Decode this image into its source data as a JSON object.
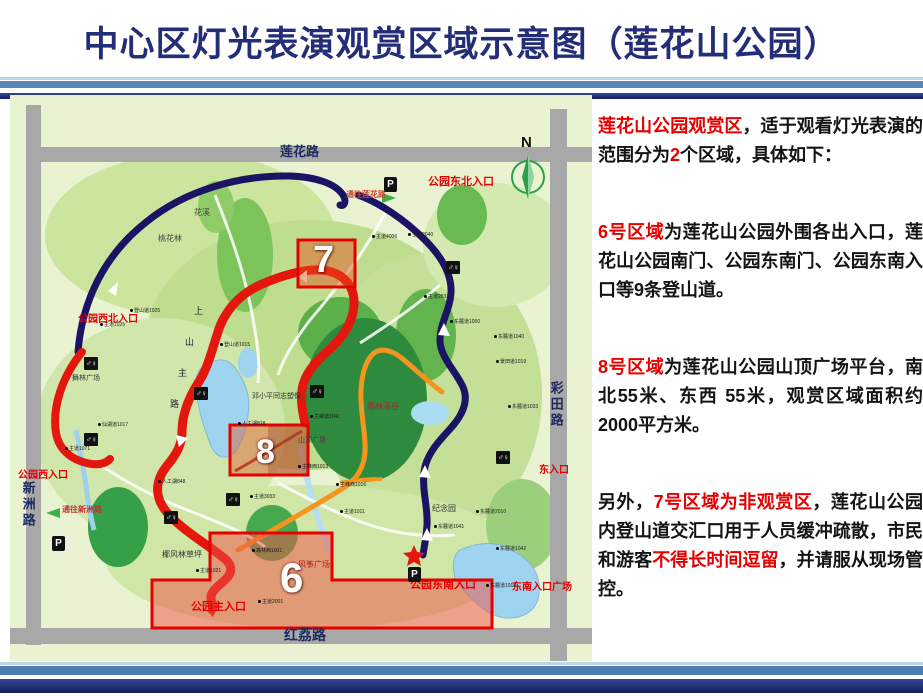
{
  "title": "中心区灯光表演观赏区域示意图（莲花山公园）",
  "colors": {
    "title": "#242e78",
    "red_accent": "#e60000",
    "map_bg": "#e9f2d1",
    "route_blue": "#1b1464",
    "route_red": "#e3170d",
    "route_orange": "#f5941f",
    "road_gray": "#a8a8a8",
    "region_fill": "rgba(240,85,60,0.5)"
  },
  "panel": {
    "paragraphs": [
      {
        "gap": "none",
        "segments": [
          {
            "t": "莲花山公园观赏区",
            "red": true
          },
          {
            "t": "，适于观看灯光表演的范围分为",
            "red": false
          },
          {
            "t": "2",
            "red": true
          },
          {
            "t": "个区域，具体如下：",
            "red": false
          }
        ]
      },
      {
        "gap": "gap2",
        "segments": [
          {
            "t": "6号区域",
            "red": true
          },
          {
            "t": "为莲花山公园外围各出入口，莲花山公园南门、公园东南门、公园东南入口等9条登山道。",
            "red": false
          }
        ]
      },
      {
        "gap": "gap2",
        "segments": [
          {
            "t": "8号区域",
            "red": true
          },
          {
            "t": "为莲花山公园山顶广场平台，南北55米、东西 55米，观赏区域面积约2000平方米。",
            "red": false
          }
        ]
      },
      {
        "gap": "gap2",
        "segments": [
          {
            "t": "另外，",
            "red": false
          },
          {
            "t": "7号区域为非观赏区",
            "red": true
          },
          {
            "t": "，莲花山公园内登山道交汇口用于人员缓冲疏散，市民和游客",
            "red": false
          },
          {
            "t": "不得长时间逗留",
            "red": true
          },
          {
            "t": "，并请服从现场管控。",
            "red": false
          }
        ]
      }
    ]
  },
  "map": {
    "roads": {
      "top": "莲花路",
      "right": "彩田路",
      "bottom": "红荔路",
      "left": "新洲路"
    },
    "compass": "N",
    "regions": [
      {
        "id": "region-7",
        "label": "7",
        "x": 303,
        "y": 146,
        "size": 38
      },
      {
        "id": "region-8",
        "label": "8",
        "x": 246,
        "y": 340,
        "size": 34
      },
      {
        "id": "region-6",
        "label": "6",
        "x": 270,
        "y": 462,
        "size": 42
      }
    ],
    "labels": [
      {
        "t": "莲花路",
        "x": 270,
        "y": 50,
        "s": 13,
        "c": "#1c2a60",
        "b": 1
      },
      {
        "t": "红荔路",
        "x": 274,
        "y": 533,
        "s": 14,
        "c": "#1c2a60",
        "b": 1
      },
      {
        "t": "彩田路",
        "x": 539,
        "y": 286,
        "s": 13,
        "c": "#1c2a60",
        "b": 1,
        "v": 1
      },
      {
        "t": "新洲路",
        "x": 11,
        "y": 386,
        "s": 13,
        "c": "#1c2a60",
        "b": 1,
        "v": 1
      },
      {
        "t": "N",
        "x": 511,
        "y": 40,
        "s": 15,
        "c": "#111111",
        "b": 1
      },
      {
        "t": "公园东北入口",
        "x": 418,
        "y": 82,
        "s": 11,
        "c": "#e60000",
        "b": 1
      },
      {
        "t": "通往莲花路",
        "x": 336,
        "y": 96,
        "s": 8,
        "c": "#cc4433",
        "b": 1
      },
      {
        "t": "公园西北入口",
        "x": 68,
        "y": 220,
        "s": 10,
        "c": "#e60000",
        "b": 1
      },
      {
        "t": "公园西入口",
        "x": 8,
        "y": 376,
        "s": 10,
        "c": "#e60000",
        "b": 1
      },
      {
        "t": "通往新洲路",
        "x": 52,
        "y": 411,
        "s": 8,
        "c": "#c23333",
        "b": 1
      },
      {
        "t": "公园主入口",
        "x": 181,
        "y": 507,
        "s": 11,
        "c": "#e60000",
        "b": 1
      },
      {
        "t": "公园东南入口",
        "x": 400,
        "y": 485,
        "s": 11,
        "c": "#e60000",
        "b": 1
      },
      {
        "t": "东南入口广场",
        "x": 502,
        "y": 488,
        "s": 10,
        "c": "#e60000",
        "b": 1
      },
      {
        "t": "东入口",
        "x": 529,
        "y": 371,
        "s": 10,
        "c": "#e60000",
        "b": 1
      },
      {
        "t": "花溪",
        "x": 184,
        "y": 114,
        "s": 8,
        "c": "#444444"
      },
      {
        "t": "桃花林",
        "x": 148,
        "y": 140,
        "s": 8,
        "c": "#444444"
      },
      {
        "t": "邓小平同志塑像",
        "x": 242,
        "y": 298,
        "s": 7,
        "c": "#333333"
      },
      {
        "t": "山顶广场",
        "x": 288,
        "y": 342,
        "s": 7,
        "c": "#553333"
      },
      {
        "t": "雨林溪谷",
        "x": 357,
        "y": 308,
        "s": 8,
        "c": "#aa2233"
      },
      {
        "t": "纪念园",
        "x": 422,
        "y": 410,
        "s": 8,
        "c": "#333333"
      },
      {
        "t": "椰风林草坪",
        "x": 152,
        "y": 456,
        "s": 8,
        "c": "#333333"
      },
      {
        "t": "风筝广场",
        "x": 288,
        "y": 466,
        "s": 8,
        "c": "#aa2222"
      },
      {
        "t": "舞林广场",
        "x": 62,
        "y": 280,
        "s": 7,
        "c": "#333333"
      },
      {
        "t": "上",
        "x": 184,
        "y": 212,
        "s": 9,
        "c": "#222233"
      },
      {
        "t": "山",
        "x": 175,
        "y": 243,
        "s": 9,
        "c": "#222233"
      },
      {
        "t": "主",
        "x": 168,
        "y": 274,
        "s": 9,
        "c": "#222233"
      },
      {
        "t": "路",
        "x": 160,
        "y": 305,
        "s": 9,
        "c": "#222233"
      }
    ],
    "markers": [
      {
        "t": "主道1025",
        "x": 90,
        "y": 228
      },
      {
        "t": "登山道1025",
        "x": 120,
        "y": 214
      },
      {
        "t": "主道4006",
        "x": 362,
        "y": 140
      },
      {
        "t": "主道2040",
        "x": 398,
        "y": 138
      },
      {
        "t": "主道2833",
        "x": 414,
        "y": 200
      },
      {
        "t": "东麓道1050",
        "x": 440,
        "y": 225
      },
      {
        "t": "东麓道1040",
        "x": 484,
        "y": 240
      },
      {
        "t": "景田道1019",
        "x": 486,
        "y": 265
      },
      {
        "t": "东麓道1033",
        "x": 498,
        "y": 310
      },
      {
        "t": "主峰西1013",
        "x": 288,
        "y": 370
      },
      {
        "t": "主峰西1016",
        "x": 326,
        "y": 388
      },
      {
        "t": "主道3033",
        "x": 240,
        "y": 400
      },
      {
        "t": "人工湖848",
        "x": 148,
        "y": 385
      },
      {
        "t": "人工湖818",
        "x": 228,
        "y": 327
      },
      {
        "t": "主道1021",
        "x": 186,
        "y": 474
      },
      {
        "t": "森林西1001",
        "x": 242,
        "y": 454
      },
      {
        "t": "主道2001",
        "x": 248,
        "y": 505
      },
      {
        "t": "东麓道1041",
        "x": 424,
        "y": 430
      },
      {
        "t": "东麓道2010",
        "x": 466,
        "y": 415
      },
      {
        "t": "东麓道1042",
        "x": 486,
        "y": 452
      },
      {
        "t": "东麓道1018",
        "x": 476,
        "y": 489
      },
      {
        "t": "仙湖道1017",
        "x": 88,
        "y": 328
      },
      {
        "t": "主道1071",
        "x": 55,
        "y": 352
      },
      {
        "t": "登山道1015",
        "x": 210,
        "y": 248
      },
      {
        "t": "主道1011",
        "x": 330,
        "y": 415
      },
      {
        "t": "主峰道1041",
        "x": 300,
        "y": 320
      }
    ],
    "icons": [
      {
        "k": "parking-icon",
        "g": "P",
        "x": 374,
        "y": 82
      },
      {
        "k": "parking-icon",
        "g": "P",
        "x": 398,
        "y": 472
      },
      {
        "k": "parking-icon",
        "g": "P",
        "x": 42,
        "y": 441
      },
      {
        "k": "restroom-icon",
        "g": "♂♀",
        "x": 74,
        "y": 262
      },
      {
        "k": "restroom-icon",
        "g": "♂♀",
        "x": 184,
        "y": 292
      },
      {
        "k": "restroom-icon",
        "g": "♂♀",
        "x": 300,
        "y": 290
      },
      {
        "k": "restroom-icon",
        "g": "♂♀",
        "x": 436,
        "y": 166
      },
      {
        "k": "restroom-icon",
        "g": "♂♀",
        "x": 486,
        "y": 356
      },
      {
        "k": "restroom-icon",
        "g": "♂♀",
        "x": 154,
        "y": 416
      },
      {
        "k": "restroom-icon",
        "g": "♂♀",
        "x": 216,
        "y": 398
      },
      {
        "k": "restroom-icon",
        "g": "♂♀",
        "x": 74,
        "y": 338
      }
    ]
  }
}
